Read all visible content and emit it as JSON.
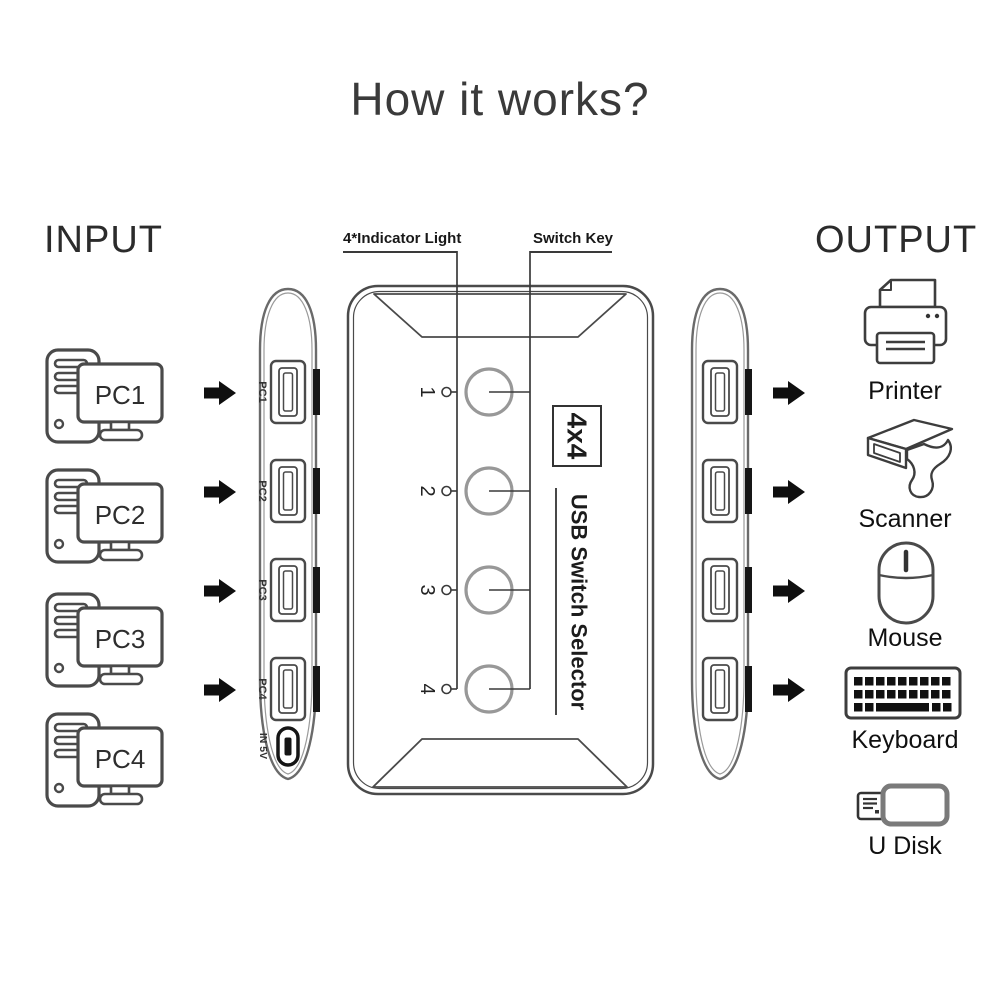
{
  "title": "How it works?",
  "input": {
    "heading": "INPUT",
    "pcs": [
      "PC1",
      "PC2",
      "PC3",
      "PC4"
    ]
  },
  "output": {
    "heading": "OUTPUT",
    "devices": [
      "Printer",
      "Scanner",
      "Mouse",
      "Keyboard",
      "U Disk"
    ]
  },
  "device": {
    "callout_indicator": "4*Indicator Light",
    "callout_switch": "Switch Key",
    "badge": "4x4",
    "name": "USB Switch Selector",
    "buttons": [
      "1",
      "2",
      "3",
      "4"
    ],
    "port_labels": [
      "PC1",
      "PC2",
      "PC3",
      "PC4"
    ],
    "power_label": "IN 5V"
  },
  "colors": {
    "ink": "#3a3a3a",
    "line": "#4a4a4a",
    "panel_outline": "#6a6a6a",
    "button_gray": "#989898",
    "solid_black": "#0f0f0f"
  }
}
